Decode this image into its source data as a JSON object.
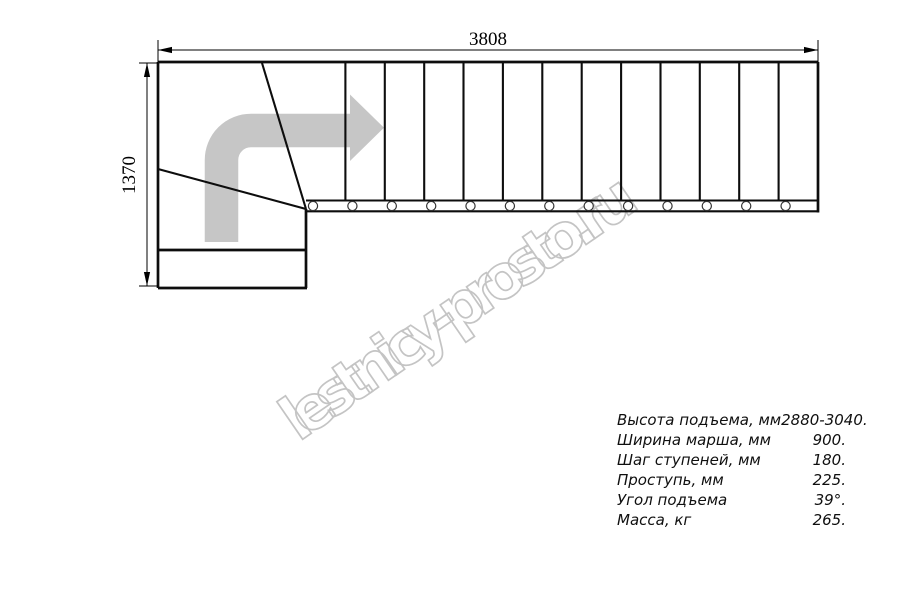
{
  "watermark": {
    "text": "lestnicy-prosto.ru"
  },
  "drawing": {
    "description": "staircase-plan-top-view",
    "dimension_top": "3808",
    "dimension_left": "1370",
    "straight_treads": 13,
    "baluster_marks": 13
  },
  "icons": {
    "direction_arrow": "curved-arrow-up-then-right"
  },
  "colors": {
    "line": "#0d0d0d",
    "arrow": "#c6c6c6",
    "watermark": "#c4c4c4"
  },
  "specs": {
    "rows": [
      {
        "label": "Высота подъема, мм",
        "value": "2880-3040."
      },
      {
        "label": "Ширина марша, мм",
        "value": "900."
      },
      {
        "label": "Шаг ступеней, мм",
        "value": "180."
      },
      {
        "label": "Проступь, мм",
        "value": "225."
      },
      {
        "label": "Угол подъема",
        "value": "39°."
      },
      {
        "label": "Масса, кг",
        "value": "265."
      }
    ]
  }
}
